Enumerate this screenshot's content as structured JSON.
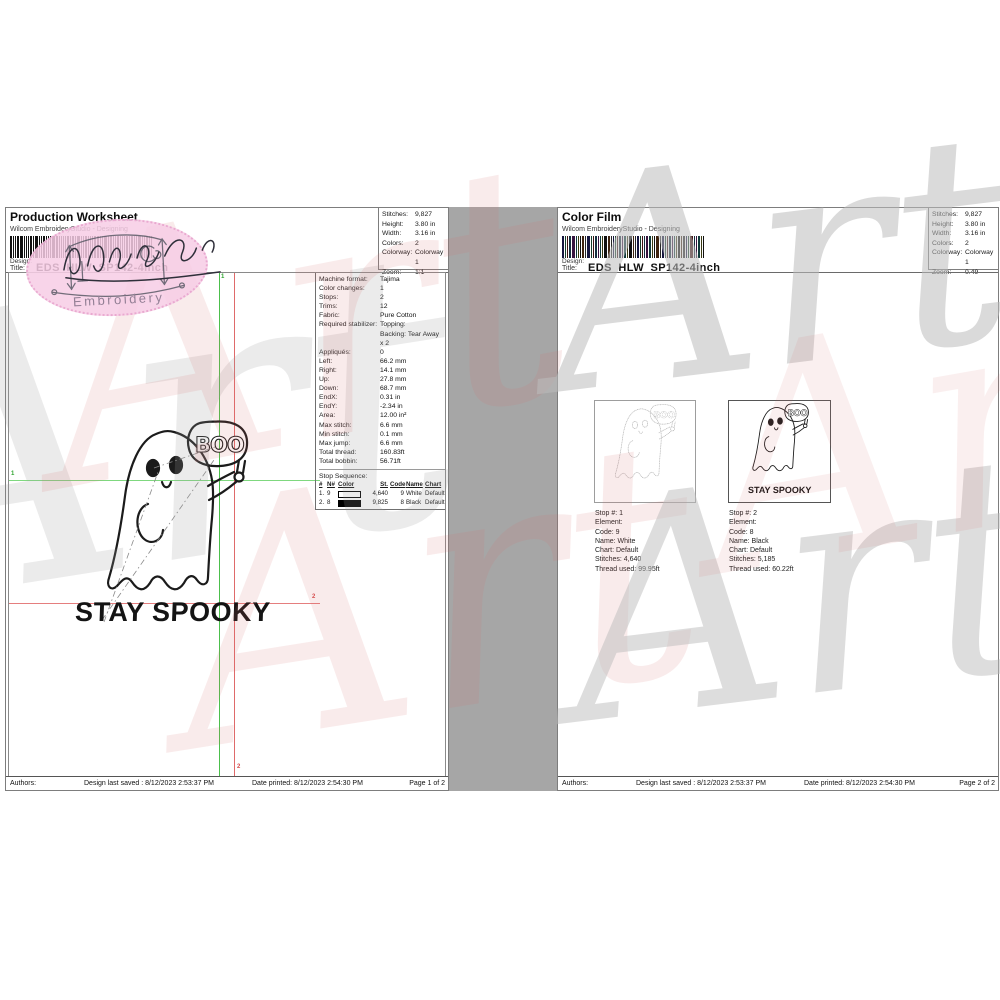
{
  "watermark": {
    "text": "Art"
  },
  "stamp": {
    "label": "Embroidery"
  },
  "artwork": {
    "sign_text": "BOO",
    "caption": "STAY SPOOKY"
  },
  "page1": {
    "title": "Production Worksheet",
    "subtitle": "Wilcom EmbroideryStudio - Designing",
    "design_label": "Design:",
    "design_value": "EDS_HLW_SP142-4inch",
    "title_label": "Title:",
    "stats": [
      {
        "label": "Stitches:",
        "value": "9,827"
      },
      {
        "label": "Height:",
        "value": "3.80 in"
      },
      {
        "label": "Width:",
        "value": "3.16 in"
      },
      {
        "label": "Colors:",
        "value": "2"
      },
      {
        "label": "Colorway:",
        "value": "Colorway 1"
      },
      {
        "label": "Zoom:",
        "value": "1:1"
      }
    ],
    "info": [
      {
        "label": "Machine format:",
        "value": "Tajima"
      },
      {
        "label": "Color changes:",
        "value": "1"
      },
      {
        "label": "Stops:",
        "value": "2"
      },
      {
        "label": "Trims:",
        "value": "12"
      },
      {
        "label": "Fabric:",
        "value": "Pure Cotton"
      },
      {
        "label": "Required stabilizer:",
        "value": "Topping:\nBacking: Tear Away\nx 2"
      },
      {
        "label": "Appliqués:",
        "value": "0"
      },
      {
        "label": "Left:",
        "value": "66.2 mm"
      },
      {
        "label": "Right:",
        "value": "14.1 mm"
      },
      {
        "label": "Up:",
        "value": "27.8 mm"
      },
      {
        "label": "Down:",
        "value": "68.7 mm"
      },
      {
        "label": "EndX:",
        "value": "0.31 in"
      },
      {
        "label": "EndY:",
        "value": "-2.34 in"
      },
      {
        "label": "Area:",
        "value": "12.00 in²"
      },
      {
        "label": "Max stitch:",
        "value": "6.6 mm"
      },
      {
        "label": "Min stitch:",
        "value": "0.1 mm"
      },
      {
        "label": "Max jump:",
        "value": "6.6 mm"
      },
      {
        "label": "Total thread:",
        "value": "160.83ft"
      },
      {
        "label": "Total bobbin:",
        "value": "56.71ft"
      }
    ],
    "stop_sequence": {
      "title": "Stop Sequence:",
      "headers": [
        "#",
        "N#",
        "Color",
        "St.",
        "Code",
        "Name",
        "Chart"
      ],
      "rows": [
        {
          "num": "1.",
          "n": "9",
          "color": "#ffffff",
          "st": "4,640",
          "code": "9",
          "name": "White",
          "chart": "Default"
        },
        {
          "num": "2.",
          "n": "8",
          "color": "#000000",
          "st": "9,825",
          "code": "8",
          "name": "Black",
          "chart": "Default"
        }
      ]
    },
    "markers": {
      "start": "1",
      "end": "2"
    },
    "footer": {
      "authors": "Authors:",
      "saved": "Design last saved : 8/12/2023 2:53:37 PM",
      "printed": "Date printed: 8/12/2023 2:54:30 PM",
      "page": "Page 1 of 2"
    }
  },
  "page2": {
    "title": "Color Film",
    "subtitle": "Wilcom EmbroideryStudio - Designing",
    "design_label": "Design:",
    "design_value": "EDS_HLW_SP142-4inch",
    "title_label": "Title:",
    "stats": [
      {
        "label": "Stitches:",
        "value": "9,827"
      },
      {
        "label": "Height:",
        "value": "3.80 in"
      },
      {
        "label": "Width:",
        "value": "3.16 in"
      },
      {
        "label": "Colors:",
        "value": "2"
      },
      {
        "label": "Colorway:",
        "value": "Colorway 1"
      },
      {
        "label": "Zoom:",
        "value": "0.49"
      }
    ],
    "films": [
      {
        "caption": [
          "Stop #: 1",
          "Element:",
          "Code: 9",
          "Name: White",
          "Chart: Default",
          "Stitches: 4,640",
          "Thread used: 99.95ft"
        ]
      },
      {
        "caption": [
          "Stop #: 2",
          "Element:",
          "Code: 8",
          "Name: Black",
          "Chart: Default",
          "Stitches: 5,185",
          "Thread used: 60.22ft"
        ]
      }
    ],
    "footer": {
      "authors": "Authors:",
      "saved": "Design last saved : 8/12/2023 2:53:37 PM",
      "printed": "Date printed: 8/12/2023 2:54:30 PM",
      "page": "Page 2 of 2"
    }
  }
}
